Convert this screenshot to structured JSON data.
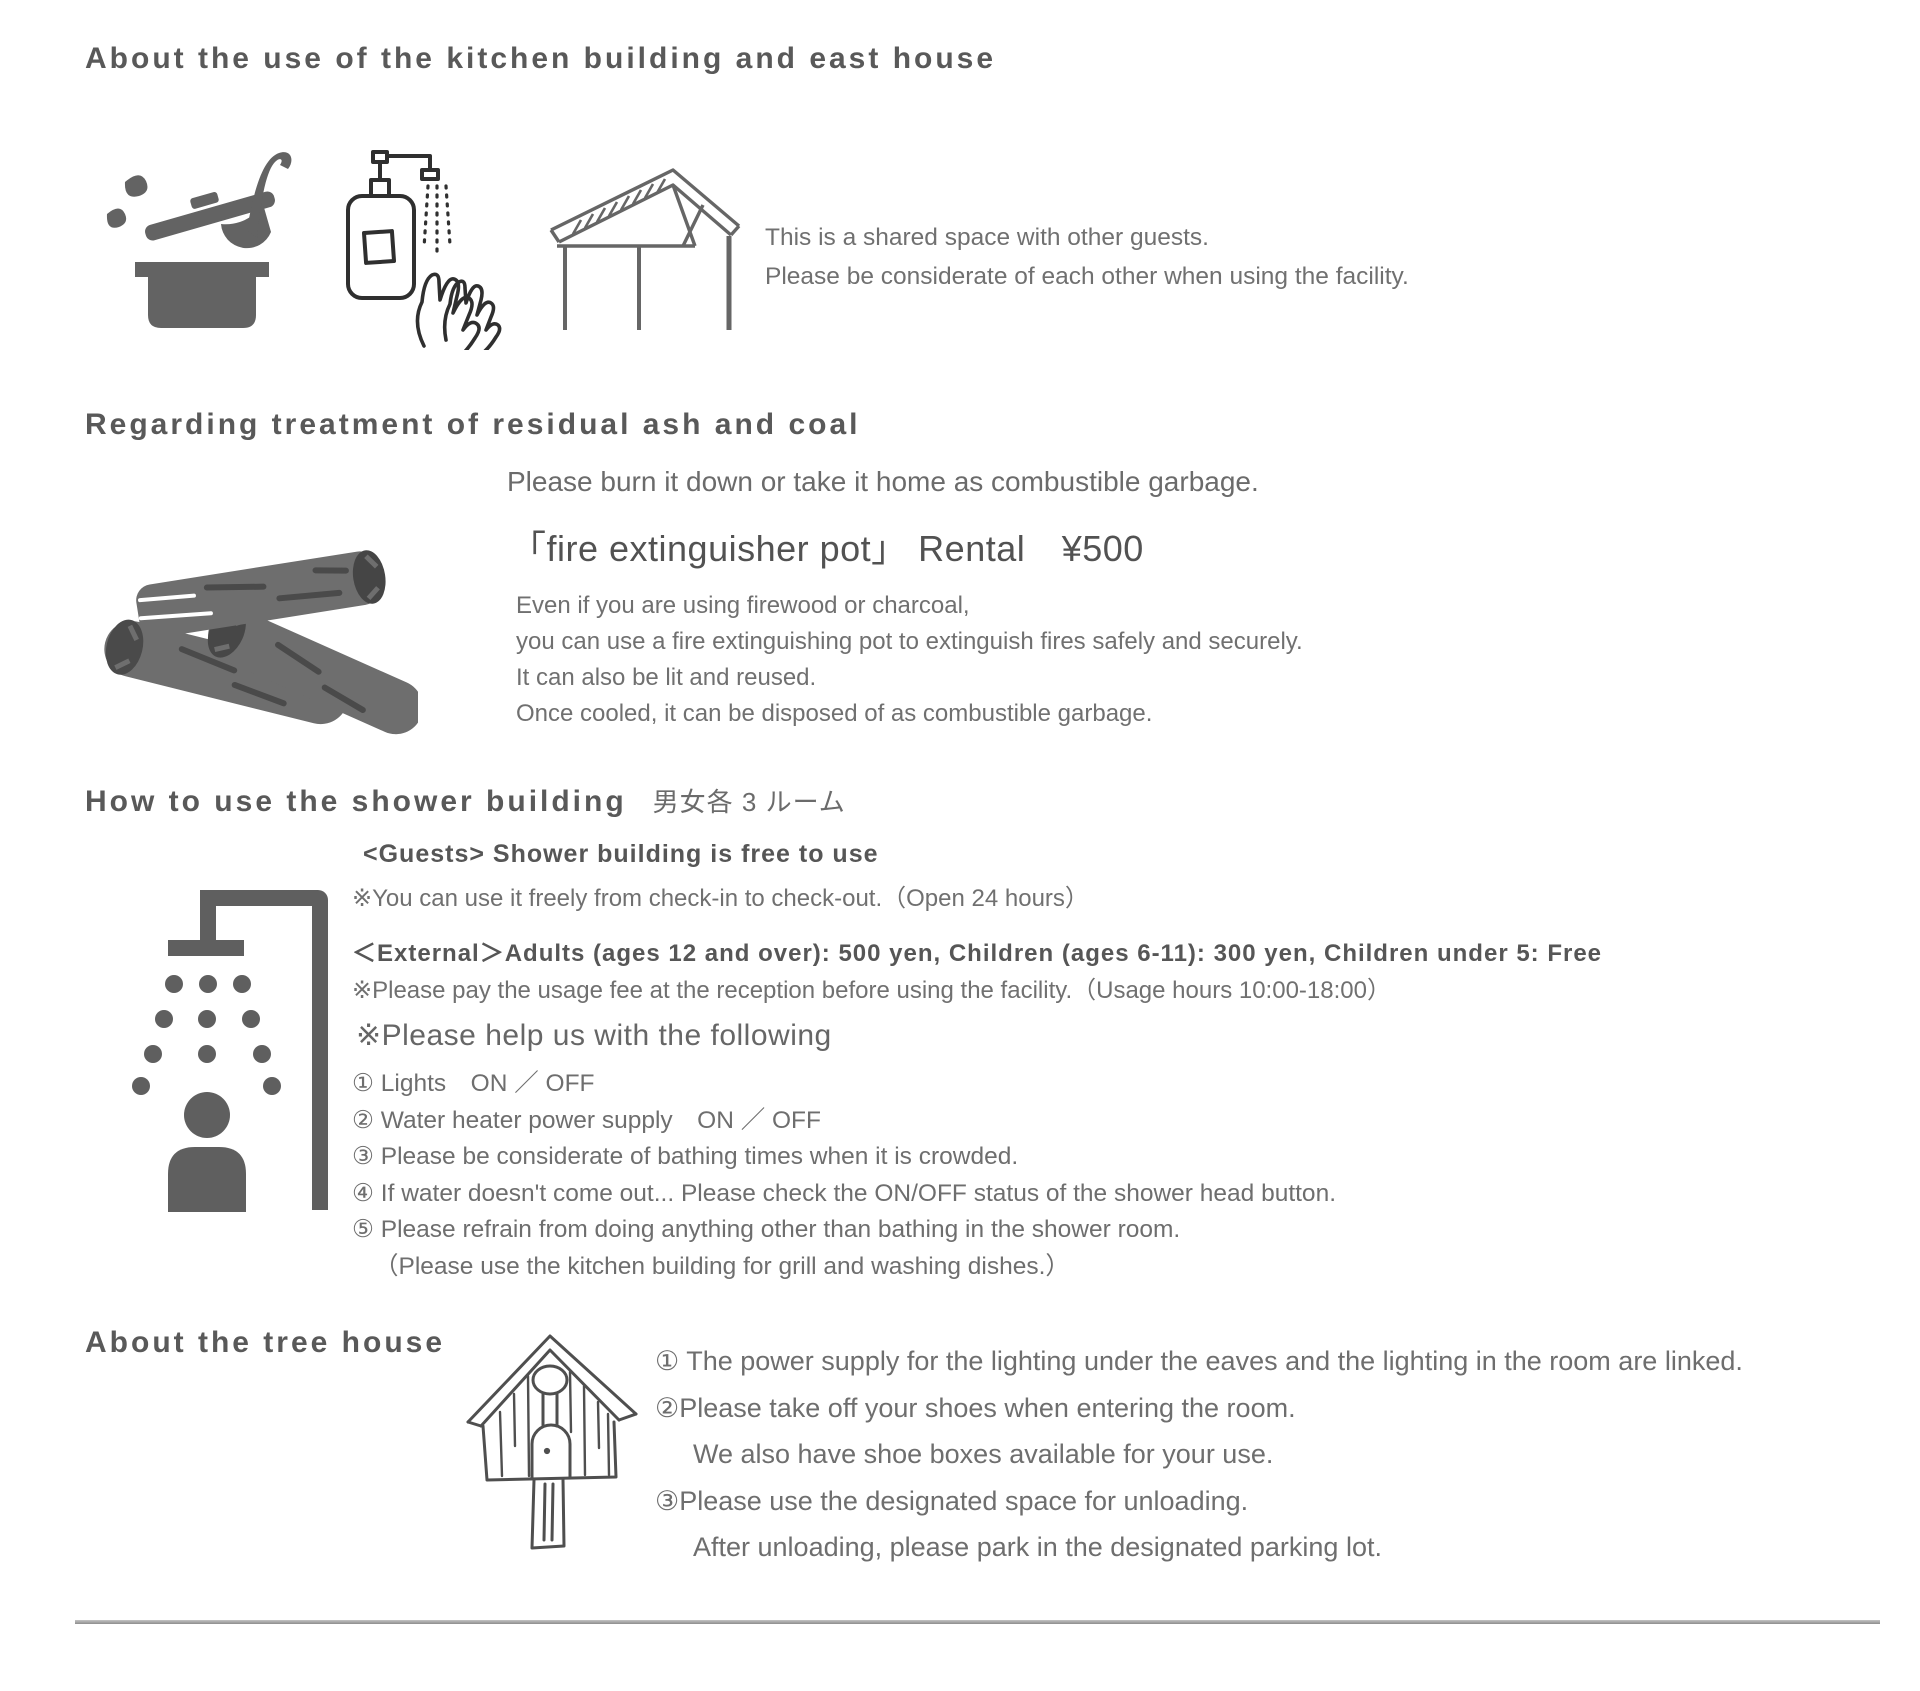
{
  "page": {
    "background": "#ffffff",
    "heading_color": "#595959",
    "body_color": "#6b6b6b",
    "icon_color": "#5f5f5f",
    "divider_color": "#9a9a9a"
  },
  "icons": {
    "kitchen_pot": "pot-ladle-icon",
    "soap_hands": "soap-handwash-icon",
    "shelter": "shelter-roof-icon",
    "firewood": "firewood-charcoal-icon",
    "shower": "shower-person-icon",
    "birdhouse": "birdhouse-icon"
  },
  "kitchen_section": {
    "title": "About the use of the kitchen building and east house",
    "lines": [
      "This is a shared space with other guests.",
      "Please be considerate of each other when using the facility."
    ]
  },
  "ash_section": {
    "title": "Regarding treatment of residual ash and coal",
    "intro": "Please burn it down or take it home as combustible garbage.",
    "rental_title": "「fire extinguisher pot」 Rental　¥500",
    "details": [
      "Even if you are using firewood or charcoal,",
      "you can use a fire extinguishing pot to extinguish fires safely and securely.",
      "It can also be lit and reused.",
      "Once cooled, it can be disposed of as combustible garbage."
    ]
  },
  "shower_section": {
    "title": "How to use the shower building",
    "title_suffix": "男女各 3 ルーム",
    "guests_heading": "<Guests> Shower building is free to use",
    "guests_note": "※You can use it freely from check-in to check-out.（Open 24 hours）",
    "external_heading": "＜External＞Adults (ages 12 and over): 500 yen, Children (ages 6-11): 300 yen, Children under 5: Free",
    "external_note": "※Please pay the usage fee at the reception before using the facility.（Usage hours 10:00-18:00）",
    "help_heading": "※Please help us with the following",
    "rules": [
      "① Lights　ON ／ OFF",
      "② Water heater power supply　ON ／ OFF",
      "③ Please be considerate of bathing times when it is crowded.",
      "④ If water doesn't come out... Please check the ON/OFF status of the shower head button.",
      "⑤ Please refrain from doing anything other than bathing in the shower room.",
      "（Please use the kitchen building for grill and washing dishes.）"
    ]
  },
  "treehouse_section": {
    "title": "About the tree house",
    "rules": [
      "① The power supply for the lighting under the eaves and the lighting in the room are linked.",
      "②Please take off your shoes when entering the room.",
      "We also have shoe boxes available for your use.",
      "③Please use the designated space for unloading.",
      "After unloading, please park in the designated parking lot."
    ]
  }
}
